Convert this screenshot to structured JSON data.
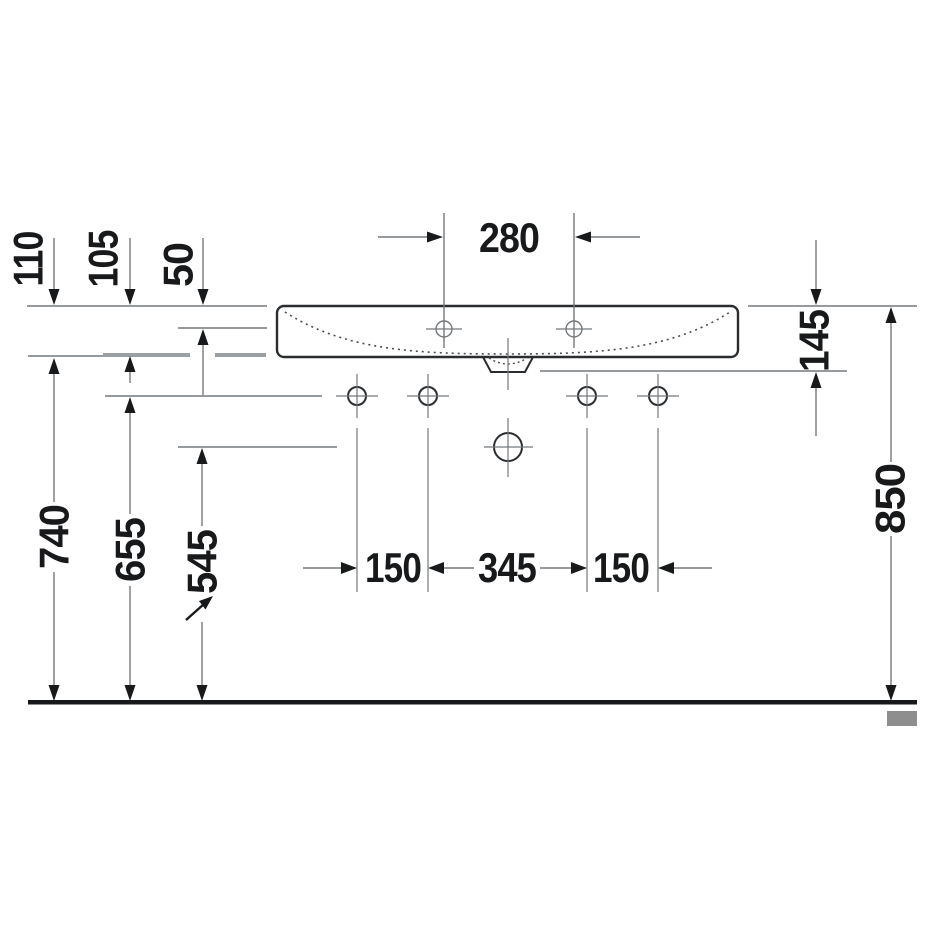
{
  "figure": {
    "kind": "technical-dimension-drawing",
    "view": "washbasin front elevation"
  },
  "dims": {
    "w280": "280",
    "h110": "110",
    "h105": "105",
    "h50": "50",
    "d145": "145",
    "h850": "850",
    "h740": "740",
    "h655": "655",
    "h545": "545",
    "s150a": "150",
    "s345": "345",
    "s150b": "150"
  },
  "colors": {
    "line_gray": "#75797c",
    "dark": "#17191b",
    "hidden_gray": "#9aa0a3",
    "wall_gray": "#8e8e8e",
    "background": "#ffffff"
  }
}
